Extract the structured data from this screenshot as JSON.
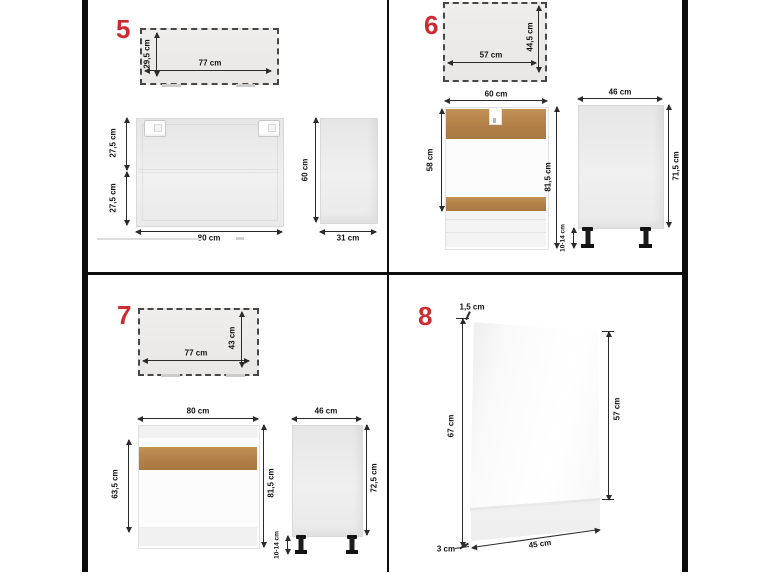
{
  "colors": {
    "accent_red": "#ce2b30",
    "wood": "#b8864e",
    "frame_black": "#0d0d0d"
  },
  "panel5": {
    "number": "5",
    "top_view": {
      "width": "77 cm",
      "depth": "29,5 cm"
    },
    "front": {
      "width": "80 cm",
      "upper": "27,5 cm",
      "lower": "27,5 cm"
    },
    "side": {
      "height": "60 cm",
      "depth": "31 cm"
    }
  },
  "panel6": {
    "number": "6",
    "top_view": {
      "width": "57 cm",
      "depth": "44,5 cm"
    },
    "front": {
      "width": "60 cm",
      "opening": "58 cm",
      "height": "81,5 cm"
    },
    "side": {
      "depth": "46 cm",
      "height": "71,5 cm",
      "legs": "10-14 cm"
    }
  },
  "panel7": {
    "number": "7",
    "top_view": {
      "width": "77 cm",
      "depth": "43 cm"
    },
    "front": {
      "width": "80 cm",
      "door": "63,5 cm",
      "height": "81,5 cm"
    },
    "side": {
      "depth": "46 cm",
      "height": "72,5 cm",
      "legs": "10-14 cm"
    }
  },
  "panel8": {
    "number": "8",
    "thickness": "1,5 cm",
    "height": "67 cm",
    "front_height": "57 cm",
    "plinth": "3 cm",
    "width": "45 cm"
  }
}
